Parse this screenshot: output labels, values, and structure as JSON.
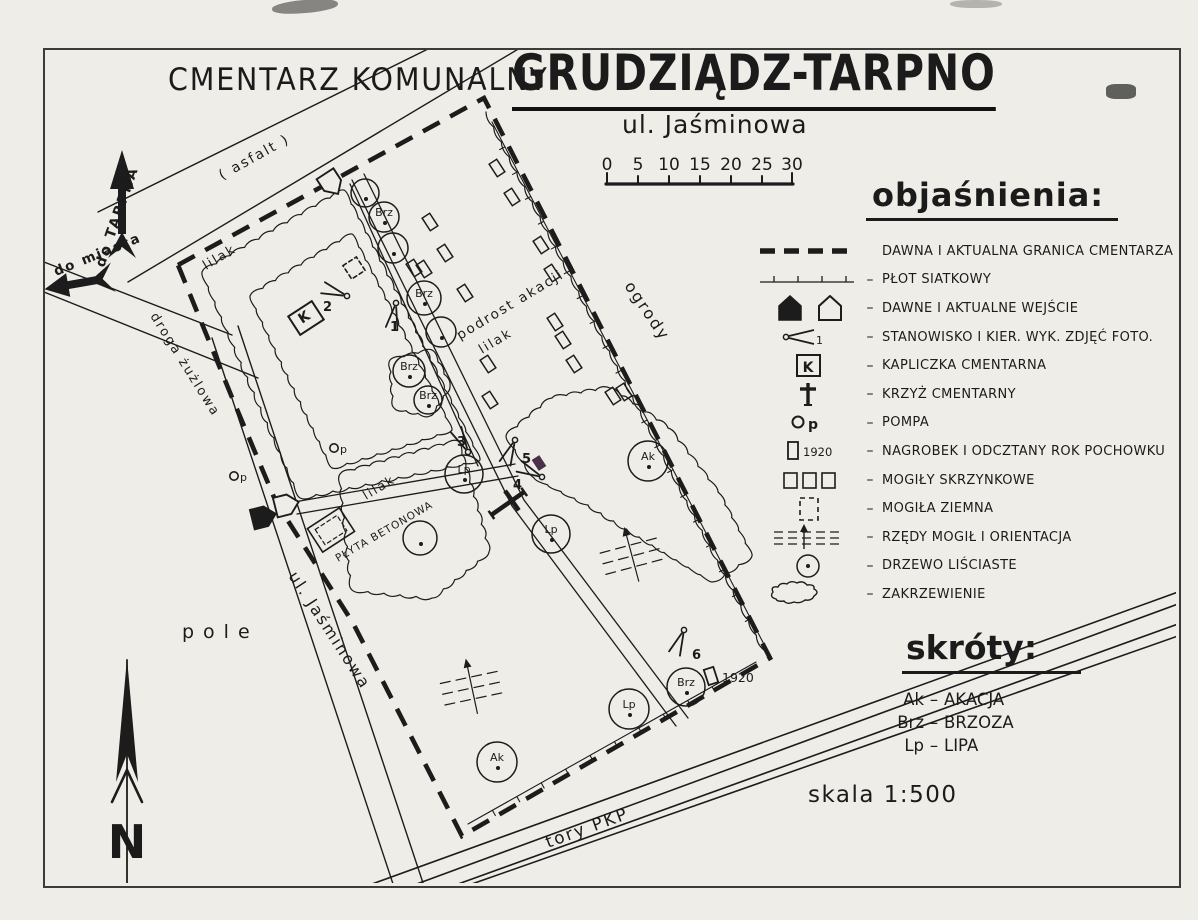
{
  "title": {
    "left": "CMENTARZ KOMUNALNY",
    "main": "GRUDZIĄDZ-TARPNO",
    "subtitle": "ul. Jaśminowa"
  },
  "scale_bar": {
    "ticks": [
      "0",
      "5",
      "10",
      "15",
      "20",
      "25",
      "30"
    ]
  },
  "legend": {
    "title": "objaśnienia:",
    "items": [
      {
        "id": "boundary",
        "label": "DAWNA I AKTUALNA GRANICA CMENTARZA",
        "icon_text": ""
      },
      {
        "id": "fence",
        "label": "PŁOT SIATKOWY",
        "icon_text": ""
      },
      {
        "id": "entrances",
        "label": "DAWNE I AKTUALNE WEJŚCIE",
        "icon_text": ""
      },
      {
        "id": "photo-station",
        "label": "STANOWISKO I KIER. WYK. ZDJĘĆ FOTO.",
        "icon_text": "1"
      },
      {
        "id": "chapel",
        "label": "KAPLICZKA CMENTARNA",
        "icon_text": "K"
      },
      {
        "id": "cross",
        "label": "KRZYŻ CMENTARNY",
        "icon_text": ""
      },
      {
        "id": "pump",
        "label": "POMPA",
        "icon_text": "p"
      },
      {
        "id": "gravestone",
        "label": "NAGROBEK I ODCZTANY ROK POCHOWKU",
        "icon_text": "1920"
      },
      {
        "id": "box-graves",
        "label": "MOGIŁY SKRZYNKOWE",
        "icon_text": ""
      },
      {
        "id": "earth-grave",
        "label": "MOGIŁA ZIEMNA",
        "icon_text": ""
      },
      {
        "id": "grave-rows",
        "label": "RZĘDY MOGIŁ I ORIENTACJA",
        "icon_text": ""
      },
      {
        "id": "tree",
        "label": "DRZEWO LIŚCIASTE",
        "icon_text": ""
      },
      {
        "id": "shrubs",
        "label": "ZAKRZEWIENIE",
        "icon_text": ""
      }
    ]
  },
  "abbreviations": {
    "title": "skróty:",
    "items": [
      {
        "abbr": "Ak",
        "name": "AKACJA"
      },
      {
        "abbr": "Brz",
        "name": "BRZOZA"
      },
      {
        "abbr": "Lp",
        "name": "LIPA"
      }
    ]
  },
  "scale_text": "skala 1:500",
  "compass": {
    "label": "N"
  },
  "map": {
    "labels": {
      "asfalt": "( asfalt )",
      "do_tarpna": "do TARPNA",
      "do_miasta": "do miasta",
      "droga_zuzlowa": "droga żużlowa",
      "ul_jasminowa": "ul. Jaśminowa",
      "pole": "pole",
      "ogrody": "ogrody",
      "tory_pkp": "tory PKP",
      "lilak": "lilak",
      "podrost_akacji": "podrost akacji",
      "plyta_betonowa": "PŁYTA BETONOWA",
      "chapel_k": "K",
      "pump_p": "p",
      "year_1920": "1920"
    },
    "trees": [
      {
        "x": 365,
        "y": 193,
        "r": 14,
        "label": ""
      },
      {
        "x": 384,
        "y": 217,
        "r": 15,
        "label": "Brz"
      },
      {
        "x": 393,
        "y": 248,
        "r": 15,
        "label": ""
      },
      {
        "x": 424,
        "y": 298,
        "r": 17,
        "label": "Brz"
      },
      {
        "x": 441,
        "y": 332,
        "r": 15,
        "label": ""
      },
      {
        "x": 409,
        "y": 371,
        "r": 16,
        "label": "Brz"
      },
      {
        "x": 428,
        "y": 400,
        "r": 14,
        "label": "Brz"
      },
      {
        "x": 648,
        "y": 461,
        "r": 20,
        "label": "Ak"
      },
      {
        "x": 551,
        "y": 534,
        "r": 19,
        "label": "Lp"
      },
      {
        "x": 464,
        "y": 474,
        "r": 19,
        "label": "Lp"
      },
      {
        "x": 420,
        "y": 538,
        "r": 17,
        "label": ""
      },
      {
        "x": 629,
        "y": 709,
        "r": 20,
        "label": "Lp"
      },
      {
        "x": 686,
        "y": 687,
        "r": 19,
        "label": "Brz"
      },
      {
        "x": 497,
        "y": 762,
        "r": 20,
        "label": "Ak"
      }
    ],
    "graves": [
      [
        497,
        168
      ],
      [
        512,
        197
      ],
      [
        430,
        222
      ],
      [
        445,
        253
      ],
      [
        414,
        268
      ],
      [
        424,
        269
      ],
      [
        465,
        293
      ],
      [
        541,
        245
      ],
      [
        552,
        273
      ],
      [
        555,
        322
      ],
      [
        563,
        340
      ],
      [
        574,
        364
      ],
      [
        488,
        364
      ],
      [
        490,
        400
      ],
      [
        613,
        396
      ],
      [
        624,
        392
      ]
    ],
    "grave_purple": {
      "x": 539,
      "y": 463,
      "color": "#4a3048"
    },
    "grave_rows": [
      {
        "x": 632,
        "y": 556,
        "rot": -15
      },
      {
        "x": 472,
        "y": 688,
        "rot": -12
      }
    ],
    "photo_stations": [
      {
        "label": "1",
        "x": 396,
        "y": 303,
        "dir": 100,
        "lx": 390,
        "ly": 331
      },
      {
        "label": "2",
        "x": 347,
        "y": 296,
        "dir": 199,
        "lx": 323,
        "ly": 311
      },
      {
        "label": "3",
        "x": 468,
        "y": 452,
        "dir": 242,
        "lx": 457,
        "ly": 446
      },
      {
        "label": "4",
        "x": 542,
        "y": 477,
        "dir": 205,
        "lx": 513,
        "ly": 489
      },
      {
        "label": "5",
        "x": 515,
        "y": 440,
        "dir": 113,
        "lx": 522,
        "ly": 463
      },
      {
        "label": "6",
        "x": 684,
        "y": 630,
        "dir": 112,
        "lx": 692,
        "ly": 659
      }
    ],
    "pumps": [
      [
        334,
        448
      ],
      [
        234,
        476
      ]
    ],
    "entrances": [
      {
        "x": 331,
        "y": 183,
        "rot": 147,
        "filled": false,
        "name": "entrance-current-north"
      },
      {
        "x": 263,
        "y": 517,
        "rot": 76,
        "filled": true,
        "name": "entrance-old-west"
      },
      {
        "x": 286,
        "y": 505,
        "rot": 76,
        "filled": false,
        "name": "entrance-current-west"
      }
    ]
  },
  "colors": {
    "ink": "#1c1c1c",
    "paper": "#efede7",
    "purple_mark": "#4a3048"
  }
}
